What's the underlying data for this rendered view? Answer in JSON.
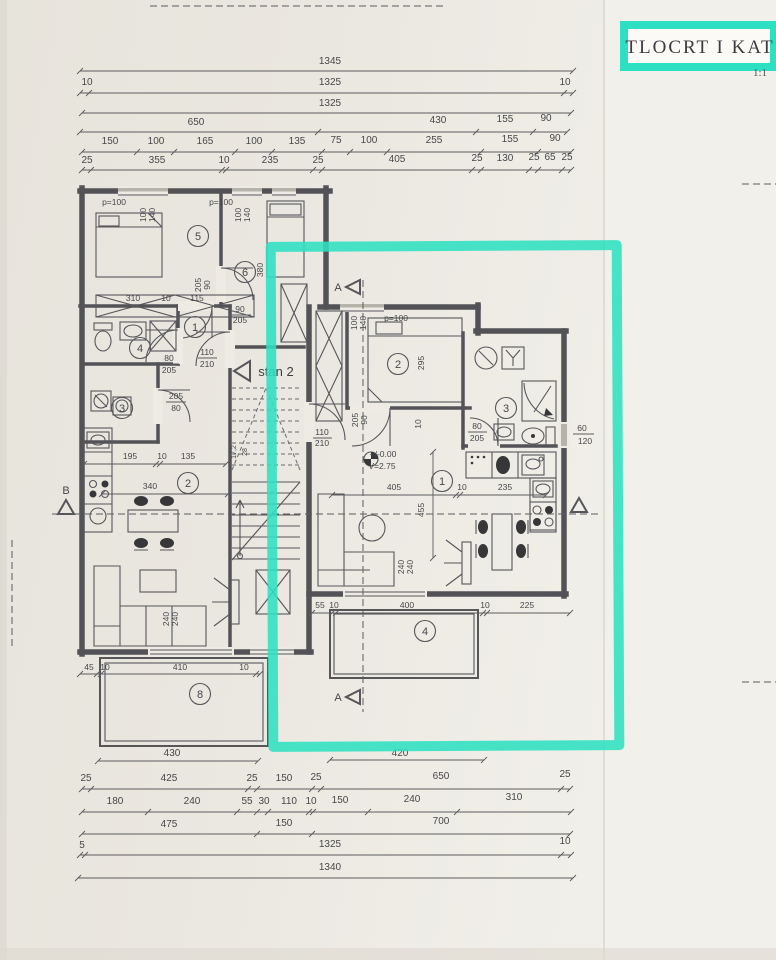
{
  "title_block": {
    "title": "TLOCRT I KAT",
    "scale": "1:1"
  },
  "highlight_color": "#2ee0c2",
  "dims_top": {
    "row1": [
      "1345"
    ],
    "row2": [
      "10",
      "1325",
      "10"
    ],
    "row3": [
      "1325"
    ],
    "row4": [
      "650",
      "430",
      "155",
      "90"
    ],
    "row5": [
      "150",
      "100",
      "165",
      "100",
      "135",
      "75",
      "100",
      "255",
      "155",
      "90"
    ],
    "row6": [
      "25",
      "355",
      "10",
      "235",
      "25",
      "405",
      "25",
      "130",
      "25",
      "65",
      "25"
    ]
  },
  "dims_bottom": {
    "terrace_left": [
      "45",
      "10",
      "410",
      "10"
    ],
    "terrace_left_width": "430",
    "terrace_right": [
      "55",
      "10",
      "400",
      "10",
      "225"
    ],
    "terrace_right_width": "420",
    "row1": [
      "25",
      "425",
      "25",
      "150",
      "25",
      "650",
      "25"
    ],
    "row2": [
      "180",
      "240",
      "55",
      "30",
      "110",
      "10",
      "150",
      "240",
      "310"
    ],
    "row3": [
      "475",
      "150",
      "700"
    ],
    "row4": [
      "5",
      "1325",
      "10"
    ],
    "row5": [
      "1340"
    ]
  },
  "stairs": {
    "unit_label": "stan 2",
    "riser": "17,2",
    "tread": "28"
  },
  "level_marker": {
    "elevation": "+/-0.00",
    "height": "V=2.75"
  },
  "sections": {
    "a": "A",
    "b": "B"
  },
  "left_apt": {
    "rooms": {
      "r1": "1",
      "r2": "2",
      "r3": "3",
      "r4": "4",
      "r5": "5",
      "r6": "6",
      "r8": "8"
    },
    "windows": {
      "w1": {
        "p": "p=100",
        "s": [
          "100",
          "140"
        ]
      },
      "w2": {
        "p": "p=100",
        "s": [
          "100",
          "140"
        ]
      }
    },
    "dims": {
      "room_door": [
        "205",
        "90"
      ],
      "hall_door": [
        "90",
        "205"
      ],
      "hall_width": "115",
      "wardrobe": "310",
      "wardrobe_gap": "10",
      "room6_depth": "380",
      "entry_door": [
        "110",
        "210"
      ],
      "bath_door": [
        "80",
        "205"
      ],
      "wc_door": [
        "205",
        "80"
      ],
      "kitchen": [
        "195",
        "10",
        "135"
      ],
      "dining": "340",
      "balcony_door": [
        "240",
        "240"
      ]
    }
  },
  "right_apt": {
    "rooms": {
      "r1": "1",
      "r2": "2",
      "r3": "3",
      "r4": "4"
    },
    "windows": {
      "w1": {
        "p": "p=100",
        "s": [
          "100",
          "140"
        ]
      },
      "bath": [
        "60",
        "120"
      ]
    },
    "dims": {
      "bedroom": "295",
      "bedroom_gap": "10",
      "room_door": [
        "205",
        "90"
      ],
      "entry_door": [
        "110",
        "210"
      ],
      "bath_door": [
        "80",
        "205"
      ],
      "living": [
        "405",
        "10",
        "235"
      ],
      "living_depth": "455",
      "balcony_door": [
        "240",
        "240"
      ]
    }
  }
}
